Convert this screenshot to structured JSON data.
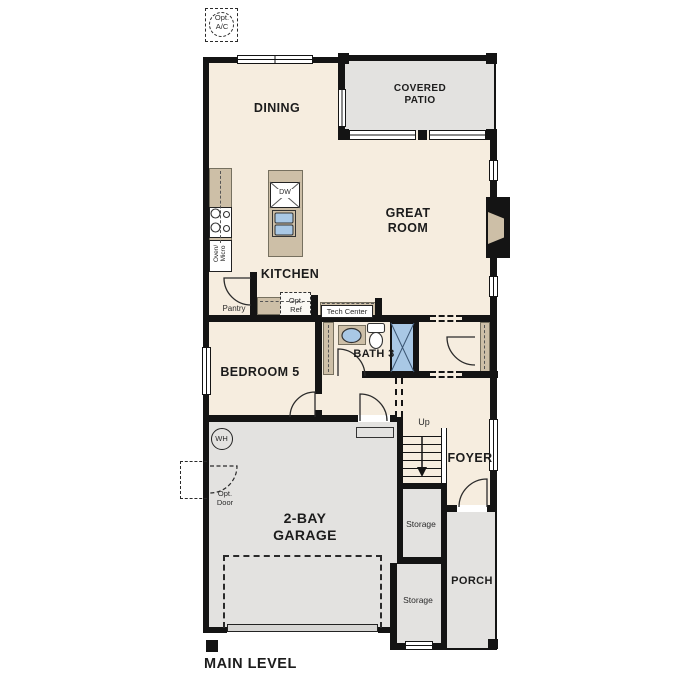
{
  "plan_title": "MAIN LEVEL",
  "rooms": {
    "dining": "DINING",
    "covered_patio": "COVERED PATIO",
    "great_room": "GREAT ROOM",
    "kitchen": "KITCHEN",
    "pantry": "Pantry",
    "bedroom5": "BEDROOM 5",
    "bath3": "BATH 3",
    "foyer": "FOYER",
    "garage": "2-BAY GARAGE",
    "porch": "PORCH",
    "storage_upper": "Storage",
    "storage_lower": "Storage"
  },
  "labels": {
    "opt_ac": "Opt. A/C",
    "opt_ref": "Opt. Ref",
    "opt_door": "Opt. Door",
    "tech_center": "Tech Center",
    "oven_micro": "Oven/ Micro",
    "dishwasher": "DW",
    "water_heater": "WH",
    "stairs_up": "Up"
  },
  "colors": {
    "floor": "#f6eddf",
    "outdoor_gray": "#e3e2e0",
    "counter_tan": "#cdbfa7",
    "fixture_blue": "#a9c8e5",
    "wall_black": "#141414"
  }
}
